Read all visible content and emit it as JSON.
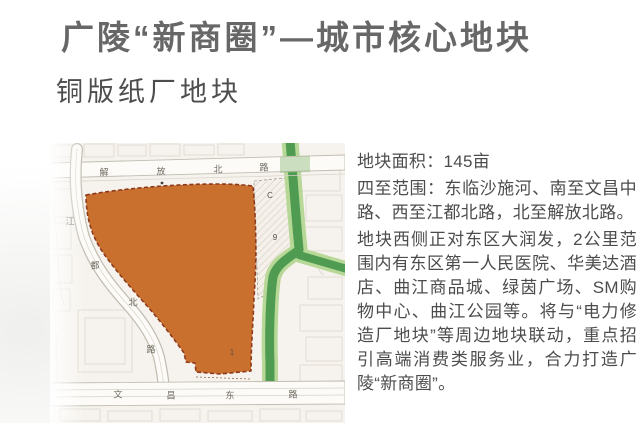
{
  "slide": {
    "title": "广陵“新商圈”—城市核心地块",
    "subtitle": "铜版纸厂地块"
  },
  "info": {
    "area_line": "地块面积：145亩",
    "boundary_line": "四至范围：东临沙施河、南至文昌中路、西至江都北路，北至解放北路。",
    "description_line": "地块西侧正对东区大润发，2公里范围内有东区第一人民医院、华美达酒店、曲江商品城、绿茵广场、SM购物中心、曲江公园等。将与“电力修造厂地块”等周边地块联动，重点招引高端消费类服务业，合力打造广陵“新商圈”。"
  },
  "map": {
    "road_names": {
      "top": "解放北路",
      "left": "江都北路",
      "bottom": "文昌东路"
    },
    "road_chars": {
      "top": [
        "解",
        "放",
        "北",
        "路"
      ],
      "left": [
        "江",
        "都",
        "北",
        "路"
      ],
      "bottom": [
        "文",
        "昌",
        "东",
        "路"
      ]
    },
    "parcel_labels": {
      "main": "1",
      "sub_c": "C",
      "sub_9": "9"
    },
    "colors": {
      "parcel": "#c9702e",
      "parcel_border": "#8e3a1c",
      "river": "#4f9b52",
      "river_edge": "#b5d794",
      "map_bg": "#f6f3ee",
      "road_fill": "#fcfbf8",
      "road_edge": "#c2bdb2",
      "block_line": "#d8d3c9"
    }
  }
}
